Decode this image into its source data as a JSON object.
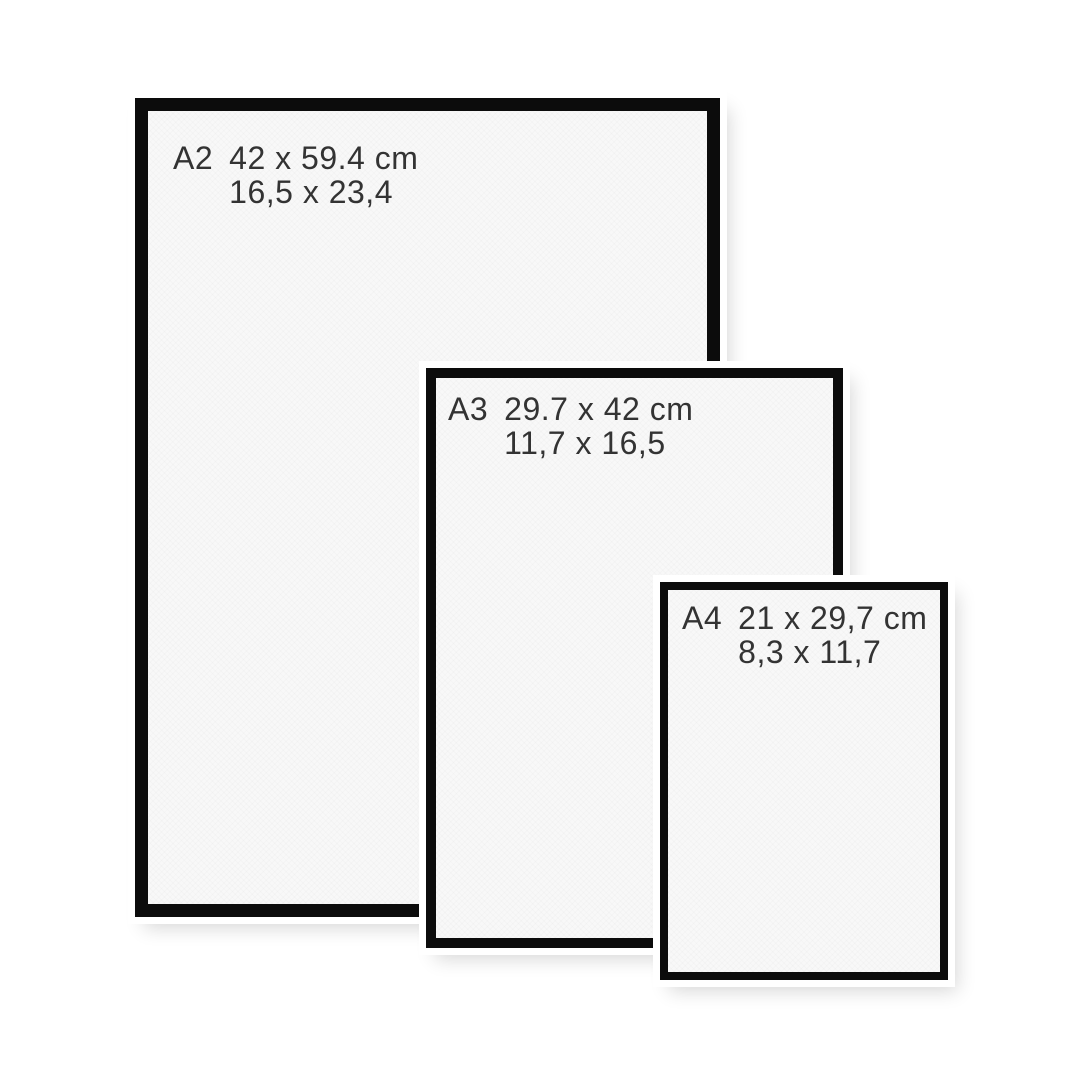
{
  "title": "Poster frame size comparison",
  "colors": {
    "background": "#ffffff",
    "frame_border": "#0c0c0c",
    "paper": "#f8f8f8",
    "text": "#333333"
  },
  "frames": [
    {
      "name": "A2",
      "metric": "42 x 59.4 cm",
      "inches": "16,5 x 23,4"
    },
    {
      "name": "A3",
      "metric": "29.7 x 42 cm",
      "inches": "11,7 x 16,5"
    },
    {
      "name": "A4",
      "metric": "21 x 29,7 cm",
      "inches": "8,3 x 11,7"
    }
  ]
}
